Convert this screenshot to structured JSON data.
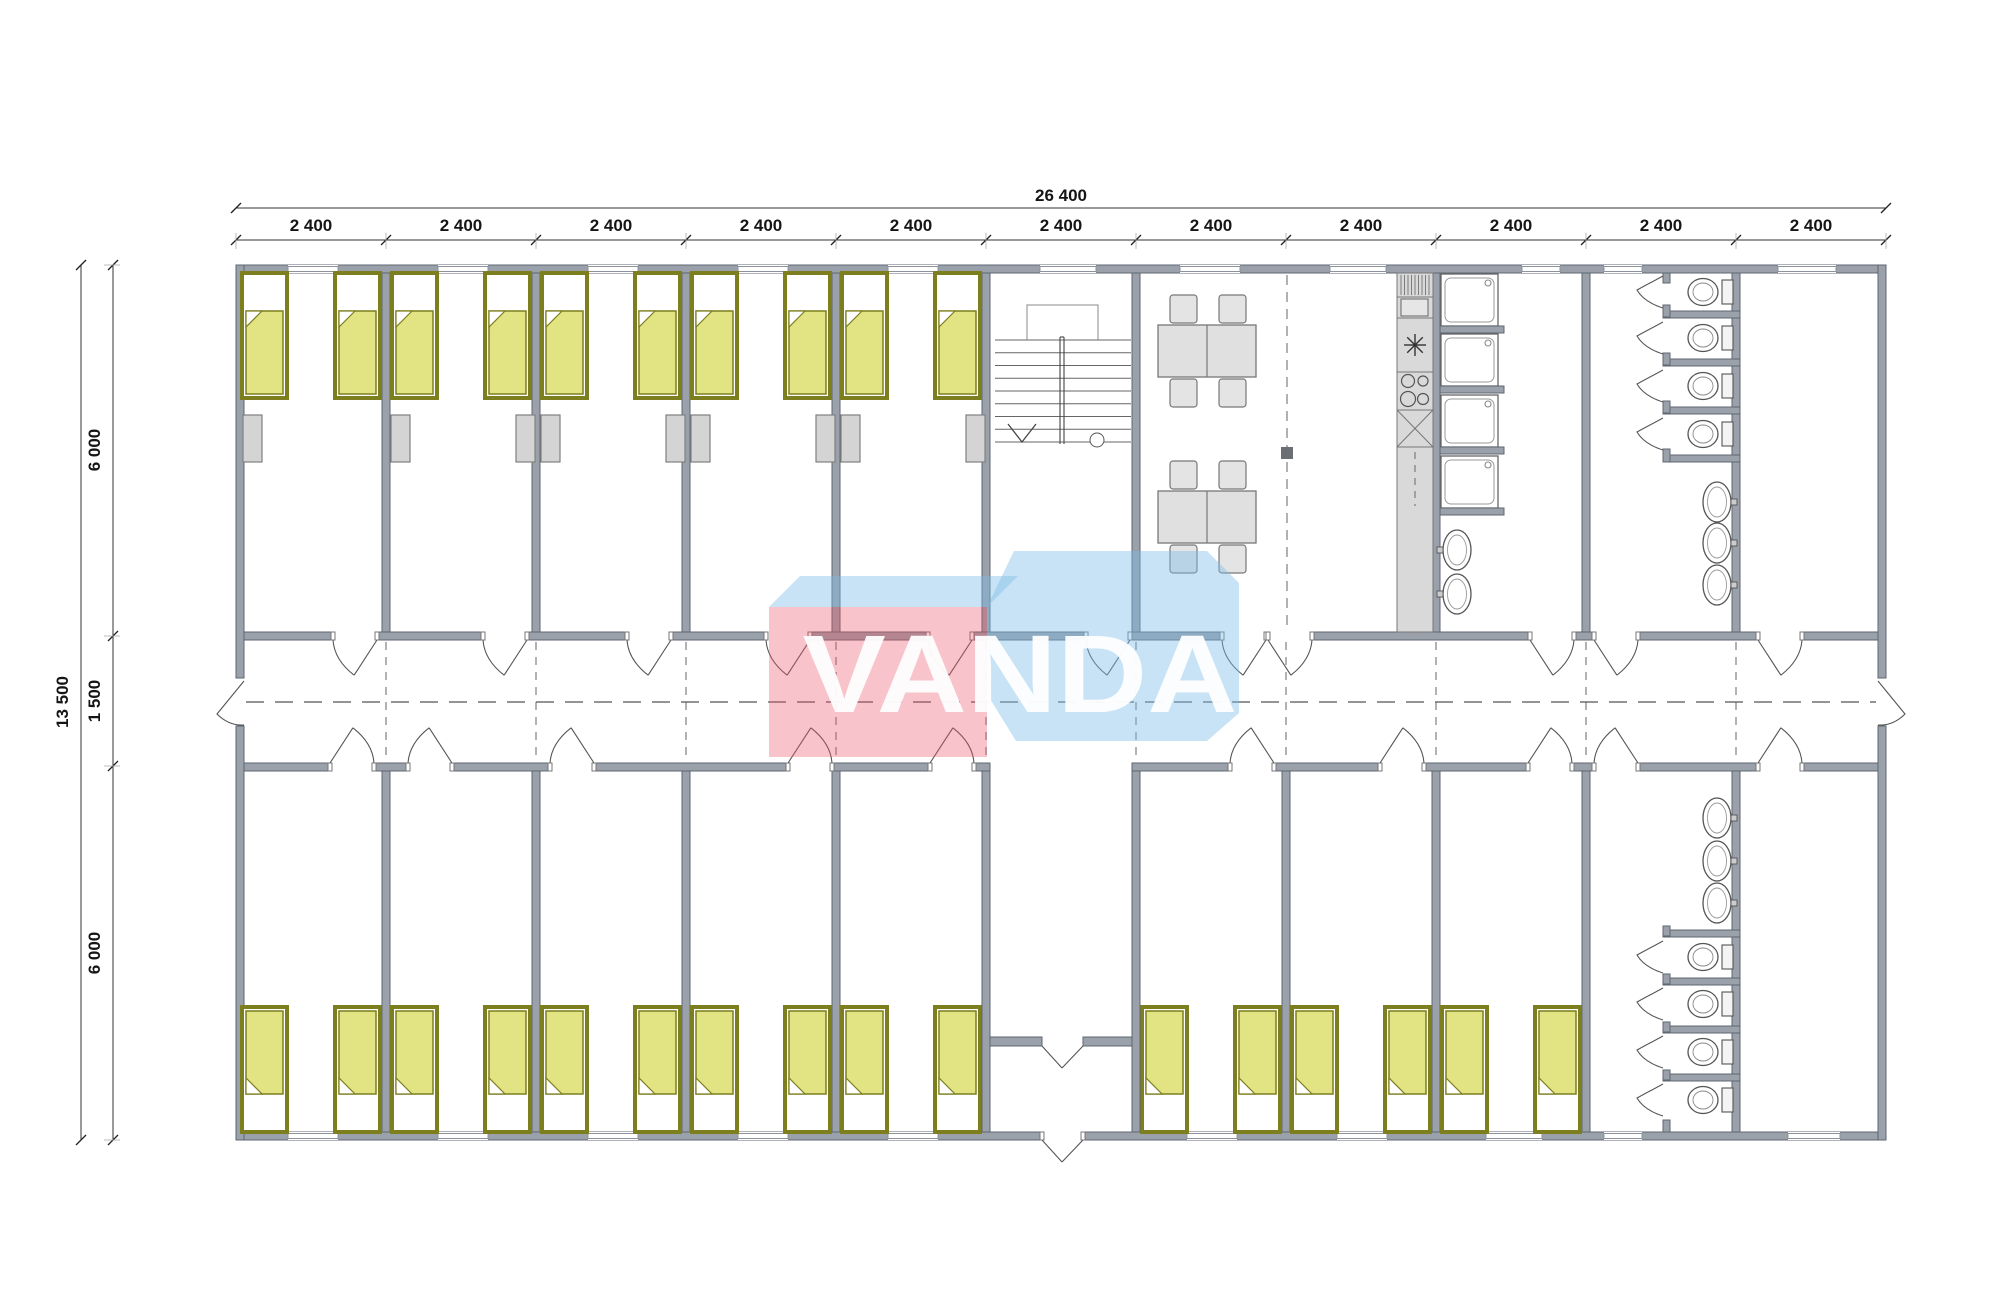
{
  "watermark": {
    "text": "VANDA",
    "pink": "#ea5063",
    "blue": "#7bbde6",
    "text_color": "#ffffff"
  },
  "dimensions": {
    "total_width_label": "26 400",
    "module_width_label": "2 400",
    "module_count": 11,
    "total_height_label": "13 500",
    "left_segments": [
      "6 000",
      "1 500",
      "6 000"
    ]
  },
  "plan": {
    "px": {
      "x0": 236,
      "x1": 1886,
      "y0": 265,
      "y1": 1140,
      "module_w": 150,
      "wall": 8,
      "corr_top": 632,
      "corr_bot": 763,
      "band_top": 273,
      "band_bot": 771
    },
    "colors": {
      "wall": "#9aa1ab",
      "wall_edge": "#5f6670",
      "line": "#555555",
      "bed_frame": "#7d7e1e",
      "bed_blanket": "#e2e484",
      "furn_fill": "#e4e4e4",
      "furn_edge": "#777777",
      "counter": "#d9d9d9",
      "nightstand": "#d4d4d4",
      "marker": "#6b6f75",
      "dim_line": "#333333"
    },
    "partitions_top": [
      386,
      536,
      686,
      836,
      986,
      1136,
      1436,
      1586,
      1736
    ],
    "partitions_bottom": [
      386,
      536,
      686,
      836,
      986,
      1136,
      1286,
      1436,
      1586,
      1736
    ],
    "axis_dashed_x": [
      386,
      536,
      686,
      836,
      986,
      1136,
      1286,
      1436,
      1586,
      1736
    ],
    "doors_top": [
      [
        333,
        377,
        "r"
      ],
      [
        483,
        527,
        "r"
      ],
      [
        627,
        671,
        "r"
      ],
      [
        766,
        810,
        "r"
      ],
      [
        928,
        972,
        "r"
      ],
      [
        1086,
        1130,
        "r"
      ],
      [
        1222,
        1266,
        "r"
      ],
      [
        1268,
        1312,
        "l"
      ],
      [
        1530,
        1574,
        "l"
      ],
      [
        1594,
        1638,
        "l"
      ],
      [
        1758,
        1802,
        "l"
      ]
    ],
    "doors_bottom": [
      [
        330,
        374,
        "l"
      ],
      [
        408,
        452,
        "r"
      ],
      [
        550,
        594,
        "r"
      ],
      [
        788,
        832,
        "l"
      ],
      [
        930,
        974,
        "l"
      ],
      [
        1230,
        1274,
        "r"
      ],
      [
        1380,
        1424,
        "l"
      ],
      [
        1528,
        1572,
        "l"
      ],
      [
        1594,
        1638,
        "r"
      ],
      [
        1758,
        1802,
        "l"
      ]
    ],
    "windows_top": [
      [
        288,
        338
      ],
      [
        438,
        488
      ],
      [
        588,
        638
      ],
      [
        738,
        788
      ],
      [
        888,
        938
      ],
      [
        1040,
        1096
      ],
      [
        1180,
        1240
      ],
      [
        1330,
        1386
      ],
      [
        1522,
        1560
      ],
      [
        1604,
        1642
      ],
      [
        1778,
        1836
      ]
    ],
    "windows_bottom": [
      [
        288,
        338
      ],
      [
        438,
        488
      ],
      [
        588,
        638
      ],
      [
        738,
        788
      ],
      [
        888,
        938
      ],
      [
        1187,
        1237
      ],
      [
        1337,
        1387
      ],
      [
        1486,
        1542
      ],
      [
        1604,
        1642
      ],
      [
        1788,
        1840
      ]
    ],
    "beds_top_x": [
      242,
      335,
      392,
      485,
      542,
      635,
      692,
      785,
      842,
      935
    ],
    "beds_bottom_x": [
      242,
      335,
      392,
      485,
      542,
      635,
      692,
      785,
      842,
      935,
      1142,
      1235,
      1292,
      1385,
      1442,
      1535
    ],
    "bed": {
      "w": 45,
      "h": 125,
      "top_y": 273,
      "bottom_y": 1007
    },
    "nightstands_x": [
      243,
      391,
      516,
      541,
      666,
      691,
      816,
      841,
      966
    ],
    "nightstand": {
      "y": 415,
      "w": 19,
      "h": 47
    },
    "tables_cy": [
      351,
      517
    ],
    "zone_divider": {
      "x": 1287,
      "y0": 275,
      "y1": 630,
      "marker": [
        1281,
        447,
        12,
        12
      ]
    },
    "kitchen": {
      "x": 1397,
      "w": 36,
      "top": 273,
      "bottom": 632,
      "seg_y": [
        297,
        318,
        372,
        410,
        447
      ],
      "hatch": [
        1401,
        275,
        1429,
        295
      ],
      "box": [
        1401,
        299,
        27,
        17
      ],
      "burner_c": [
        1415,
        345
      ],
      "hob": [
        [
          1408,
          381,
          6.5
        ],
        [
          1423,
          381,
          5
        ],
        [
          1408,
          399,
          7.5
        ],
        [
          1423,
          399,
          5.5
        ]
      ],
      "dash_x": 1415,
      "dash_y": [
        452,
        506
      ]
    },
    "showers": {
      "x": 1441,
      "w": 57,
      "h": 52,
      "ys": [
        274,
        334,
        395,
        456
      ],
      "stubs": [
        [
          1440,
          326,
          64,
          7
        ],
        [
          1440,
          386,
          64,
          7
        ],
        [
          1440,
          447,
          64,
          7
        ],
        [
          1440,
          508,
          64,
          7
        ]
      ]
    },
    "basins_shower_room": [
      [
        1457,
        550
      ],
      [
        1457,
        594
      ]
    ],
    "wc_top": {
      "wall_x": 1663,
      "partitions": [
        [
          1663,
          311,
          77,
          7
        ],
        [
          1663,
          359,
          77,
          7
        ],
        [
          1663,
          407,
          77,
          7
        ],
        [
          1663,
          455,
          77,
          7
        ]
      ],
      "stubs": [
        [
          1663,
          273,
          7,
          10
        ],
        [
          1663,
          305,
          7,
          12
        ],
        [
          1663,
          353,
          7,
          12
        ],
        [
          1663,
          401,
          7,
          12
        ],
        [
          1663,
          449,
          7,
          13
        ]
      ],
      "toilets_cy": [
        292,
        338,
        386,
        434
      ],
      "basins_cy": [
        502,
        543,
        585
      ]
    },
    "wc_bottom": {
      "wall_x": 1663,
      "partitions": [
        [
          1663,
          930,
          77,
          7
        ],
        [
          1663,
          978,
          77,
          7
        ],
        [
          1663,
          1026,
          77,
          7
        ],
        [
          1663,
          1074,
          77,
          7
        ]
      ],
      "stubs": [
        [
          1663,
          926,
          7,
          10
        ],
        [
          1663,
          974,
          7,
          10
        ],
        [
          1663,
          1022,
          7,
          10
        ],
        [
          1663,
          1070,
          7,
          10
        ],
        [
          1663,
          1120,
          7,
          12
        ]
      ],
      "toilets_cy": [
        957,
        1004,
        1052,
        1100
      ],
      "basins_cy": [
        818,
        861,
        903
      ]
    },
    "stairs": {
      "x1": 995,
      "x2": 1131,
      "tread_y0": 340,
      "tread_y1": 442,
      "treads": 9,
      "rail_x": 1060,
      "outline": [
        1027,
        305,
        71,
        35
      ],
      "arrow": [
        1008,
        424,
        1022,
        442,
        1036,
        424
      ],
      "circle": [
        1097,
        440,
        7
      ]
    },
    "vestibule": {
      "left_wall": [
        982,
        771,
        8,
        361
      ],
      "right_wall": [
        1132,
        771,
        8,
        361
      ],
      "inner_wall_y": 1037,
      "inner_wall_h": 9,
      "span": [
        990,
        1132
      ],
      "door_gap": [
        1042,
        1083
      ]
    },
    "corridor": {
      "centerline_y": 702,
      "x_start": 246,
      "x_end": 1876,
      "end_gap": [
        678,
        726
      ]
    },
    "dim": {
      "top_total_y": 208,
      "top_module_y": 240,
      "left_total_x": 81,
      "left_seg_x": 113,
      "seg_ticks_y": [
        265,
        636,
        766,
        1140
      ]
    }
  }
}
